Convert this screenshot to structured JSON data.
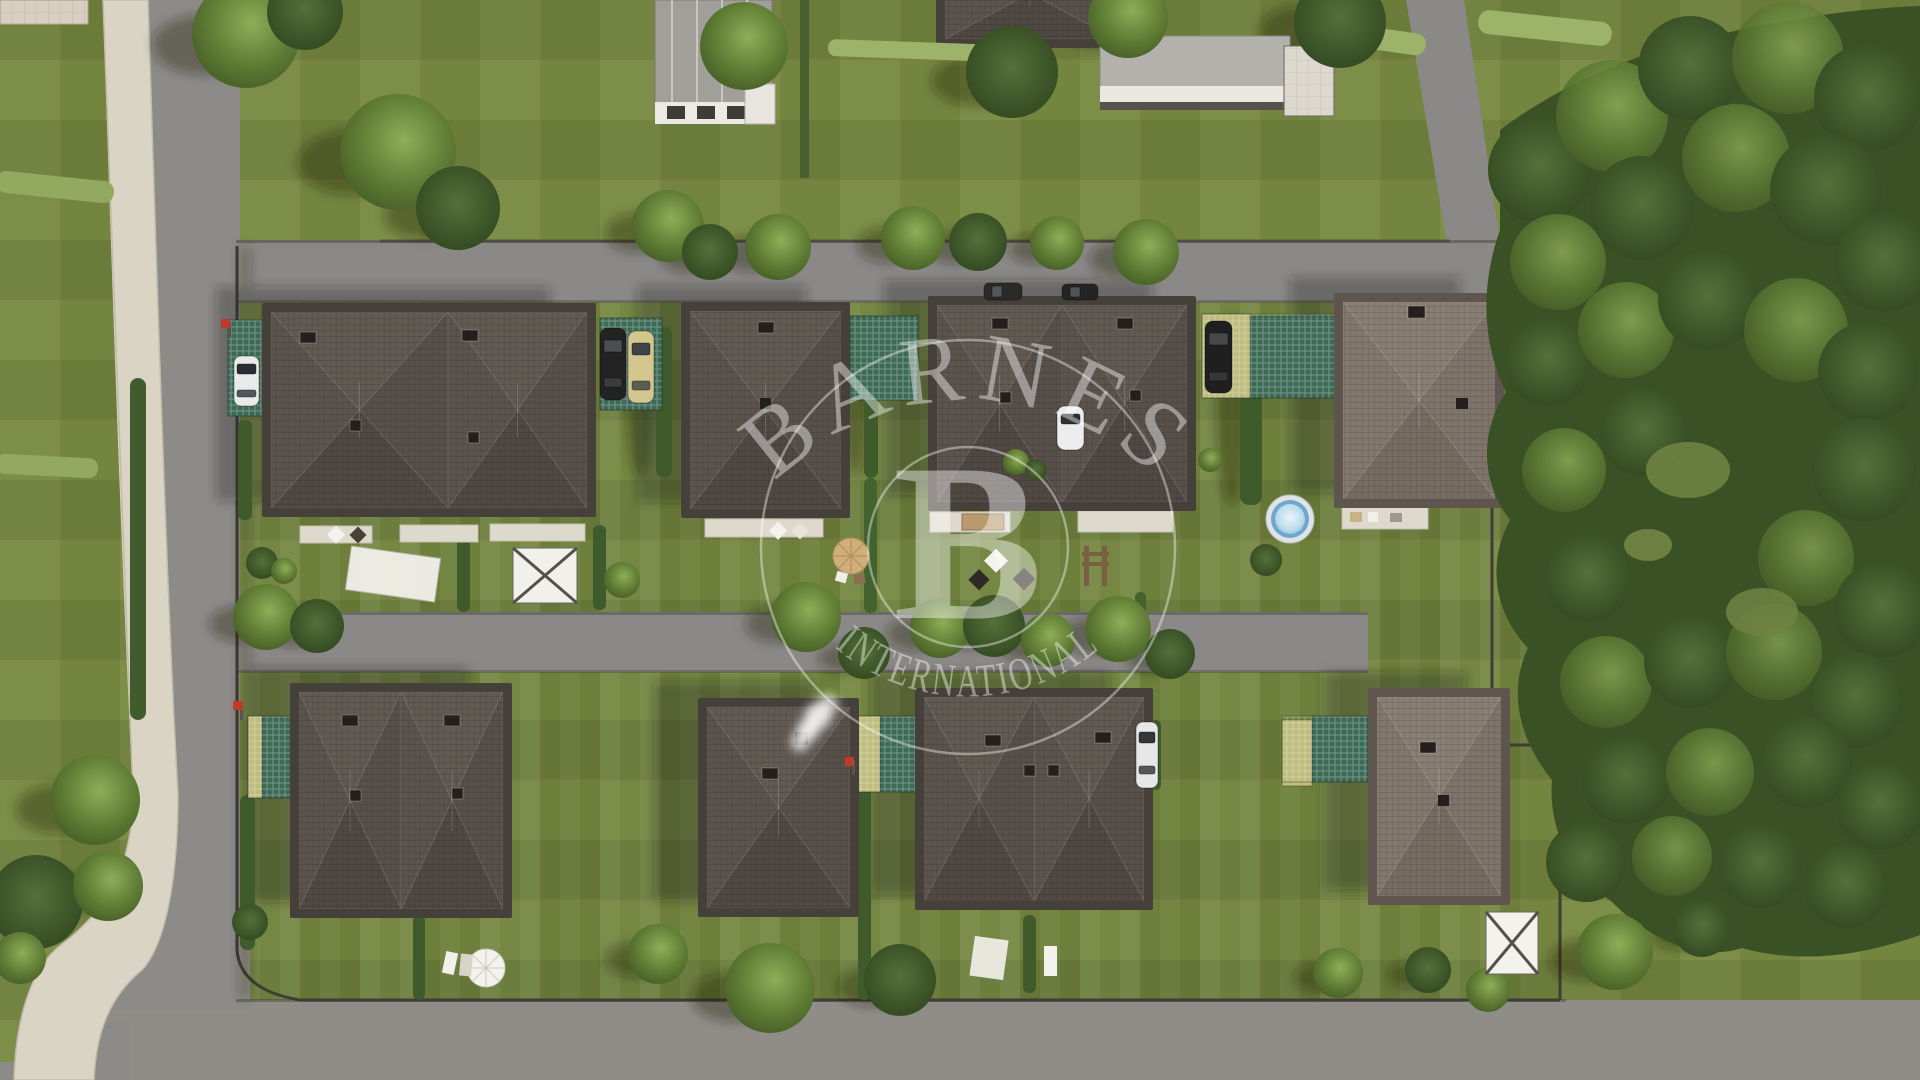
{
  "watermark": {
    "brand_top": "BARNES",
    "monogram": "B",
    "brand_bottom": "INTERNATIONAL",
    "color": "#ffffff"
  },
  "scene": {
    "type": "aerial 3D render of a residential development",
    "houses_top_row": 4,
    "houses_bottom_row": 4,
    "pool_count": 1,
    "car_count": 8,
    "palette": {
      "lawn": "#74853f",
      "lawn_light": "#7d8e48",
      "asphalt": "#8b8987",
      "path_beige": "#dad4c5",
      "roof_dark": "#5a524c",
      "roof_light": "#837a6f",
      "roof_frame": "#46403b",
      "forest": "#3a5126",
      "tree": "#5d7a33",
      "pool_water": "#9ac6e2",
      "mesh_teal": "#3d6a56",
      "mesh_yellow": "#bfbc7d",
      "car_yellow": "#d3c78f",
      "patio_white": "#ddd9cd",
      "marker_red": "#c0392b"
    }
  }
}
